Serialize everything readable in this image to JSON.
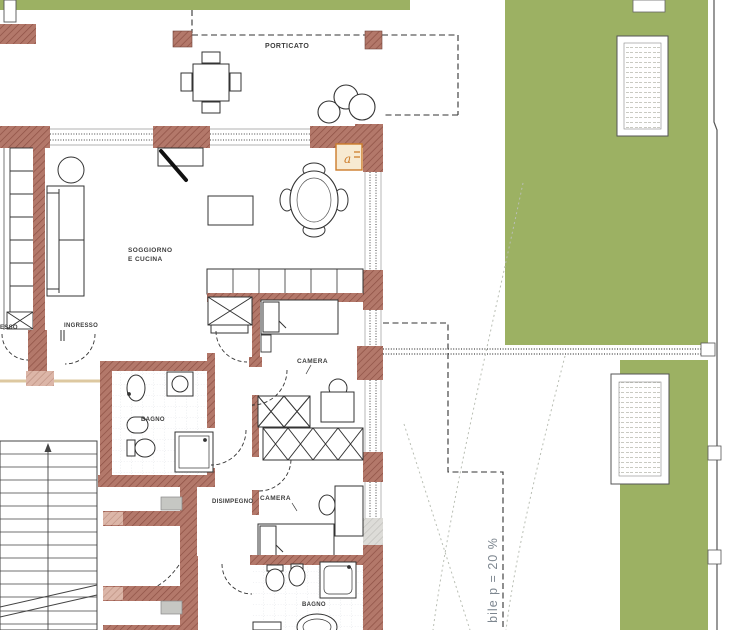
{
  "plan": {
    "labels": {
      "porticato": "PORTICATO",
      "soggiorno_line1": "SOGGIORNO",
      "soggiorno_line2": "E CUCINA",
      "ingresso_left_partial": "ESSO",
      "ingresso": "INGRESSO",
      "camera_top": "CAMERA",
      "bagno_top": "BAGNO",
      "disimpegno": "DISIMPEGNO",
      "camera_bottom": "CAMERA",
      "bagno_bottom": "BAGNO",
      "window_marker": "a",
      "slope_note_partial": "bile p = 20 %"
    },
    "colors": {
      "wall_brick": "#b3786a",
      "wall_brick_hatch": "#8d5044",
      "wall_light": "#dcb6a8",
      "garden_green": "#9cb163",
      "marker_orange": "#cc7c2a",
      "gray_block": "#c6c7c3",
      "paper": "#ffffff",
      "line": "#3f3f3f"
    }
  }
}
